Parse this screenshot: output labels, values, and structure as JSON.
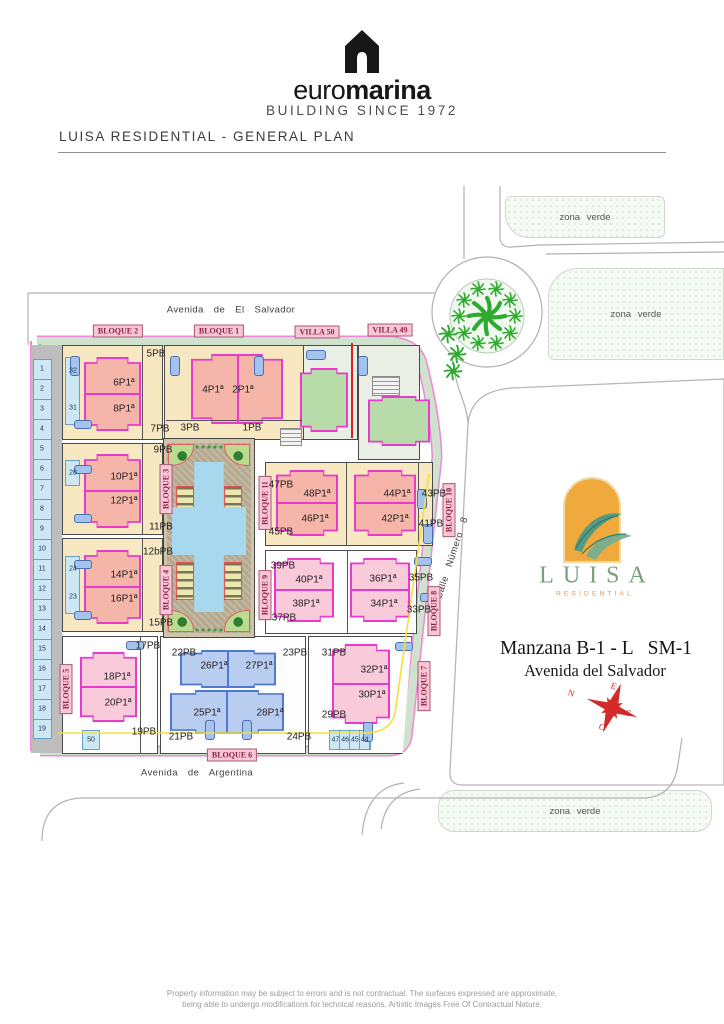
{
  "header": {
    "brand_euro": "euro",
    "brand_marina": "marina",
    "brand_tagline": "BUILDING SINCE 1972",
    "title": "LUISA RESIDENTIAL - GENERAL PLAN"
  },
  "map": {
    "streets": [
      {
        "t": "Avenida  de   El  Salvador",
        "x": 231,
        "y": 310
      },
      {
        "t": "Avenida  de  Argentina",
        "x": 197,
        "y": 773
      },
      {
        "t": "Calle  Número  8",
        "x": 452,
        "y": 558,
        "rot": -72
      }
    ],
    "badges": [
      {
        "t": "BLOQUE 2",
        "x": 118,
        "y": 331
      },
      {
        "t": "BLOQUE 1",
        "x": 219,
        "y": 331
      },
      {
        "t": "VILLA 50",
        "x": 317,
        "y": 332
      },
      {
        "t": "VILLA 49",
        "x": 390,
        "y": 330
      },
      {
        "t": "BLOQUE 6",
        "x": 232,
        "y": 755
      },
      {
        "t": "BLOQUE 5",
        "x": 66,
        "y": 689,
        "k": "v",
        "rot": 180
      },
      {
        "t": "BLOQUE 3",
        "x": 166,
        "y": 489,
        "k": "v",
        "rot": 180
      },
      {
        "t": "BLOQUE 4",
        "x": 166,
        "y": 590,
        "k": "v",
        "rot": 180
      },
      {
        "t": "BLOQUE 11",
        "x": 265,
        "y": 503,
        "k": "v",
        "rot": 180
      },
      {
        "t": "BLOQUE 9",
        "x": 265,
        "y": 595,
        "k": "v",
        "rot": 180
      },
      {
        "t": "BLOQUE 10",
        "x": 449,
        "y": 510,
        "k": "v",
        "rot": 180
      },
      {
        "t": "BLOQUE 8",
        "x": 434,
        "y": 611,
        "k": "v",
        "rot": 180
      },
      {
        "t": "BLOQUE 7",
        "x": 424,
        "y": 686,
        "k": "v",
        "rot": 180
      }
    ],
    "unit_labels": [
      {
        "t": "6P1ª",
        "x": 124,
        "y": 383,
        "k": "u"
      },
      {
        "t": "8P1ª",
        "x": 124,
        "y": 409,
        "k": "u"
      },
      {
        "t": "4P1ª",
        "x": 213,
        "y": 390,
        "k": "u"
      },
      {
        "t": "2P1ª",
        "x": 243,
        "y": 390,
        "k": "u"
      },
      {
        "t": "10P1ª",
        "x": 124,
        "y": 477,
        "k": "u"
      },
      {
        "t": "12P1ª",
        "x": 124,
        "y": 501,
        "k": "u"
      },
      {
        "t": "14P1ª",
        "x": 124,
        "y": 575,
        "k": "u"
      },
      {
        "t": "16P1ª",
        "x": 124,
        "y": 599,
        "k": "u"
      },
      {
        "t": "48P1ª",
        "x": 317,
        "y": 494,
        "k": "u"
      },
      {
        "t": "46P1ª",
        "x": 315,
        "y": 519,
        "k": "u"
      },
      {
        "t": "44P1ª",
        "x": 397,
        "y": 494,
        "k": "u"
      },
      {
        "t": "42P1ª",
        "x": 395,
        "y": 519,
        "k": "u"
      },
      {
        "t": "40P1ª",
        "x": 309,
        "y": 580,
        "k": "u"
      },
      {
        "t": "38P1ª",
        "x": 306,
        "y": 604,
        "k": "u"
      },
      {
        "t": "36P1ª",
        "x": 383,
        "y": 579,
        "k": "u"
      },
      {
        "t": "34P1ª",
        "x": 384,
        "y": 604,
        "k": "u"
      },
      {
        "t": "18P1ª",
        "x": 117,
        "y": 677,
        "k": "u"
      },
      {
        "t": "20P1ª",
        "x": 118,
        "y": 703,
        "k": "u"
      },
      {
        "t": "26P1ª",
        "x": 214,
        "y": 666,
        "k": "u"
      },
      {
        "t": "27P1ª",
        "x": 259,
        "y": 666,
        "k": "u"
      },
      {
        "t": "25P1ª",
        "x": 207,
        "y": 713,
        "k": "u"
      },
      {
        "t": "28P1ª",
        "x": 270,
        "y": 713,
        "k": "u"
      },
      {
        "t": "32P1ª",
        "x": 374,
        "y": 670,
        "k": "u"
      },
      {
        "t": "30P1ª",
        "x": 372,
        "y": 695,
        "k": "u"
      },
      {
        "t": "5PB",
        "x": 156,
        "y": 354,
        "k": "pb"
      },
      {
        "t": "7PB",
        "x": 160,
        "y": 429,
        "k": "pb"
      },
      {
        "t": "9PB",
        "x": 163,
        "y": 450,
        "k": "pb"
      },
      {
        "t": "11PB",
        "x": 161,
        "y": 527,
        "k": "pb"
      },
      {
        "t": "12bPB",
        "x": 158,
        "y": 552,
        "k": "pb"
      },
      {
        "t": "15PB",
        "x": 161,
        "y": 623,
        "k": "pb"
      },
      {
        "t": "3PB",
        "x": 190,
        "y": 428,
        "k": "pb"
      },
      {
        "t": "1PB",
        "x": 252,
        "y": 428,
        "k": "pb"
      },
      {
        "t": "47PB",
        "x": 281,
        "y": 485,
        "k": "pb"
      },
      {
        "t": "45PB",
        "x": 281,
        "y": 532,
        "k": "pb"
      },
      {
        "t": "43PB",
        "x": 434,
        "y": 494,
        "k": "pb"
      },
      {
        "t": "41PB",
        "x": 431,
        "y": 524,
        "k": "pb"
      },
      {
        "t": "39PB",
        "x": 283,
        "y": 566,
        "k": "pb"
      },
      {
        "t": "37PB",
        "x": 284,
        "y": 618,
        "k": "pb"
      },
      {
        "t": "35PB",
        "x": 421,
        "y": 578,
        "k": "pb"
      },
      {
        "t": "33PB",
        "x": 419,
        "y": 610,
        "k": "pb"
      },
      {
        "t": "17PB",
        "x": 148,
        "y": 646,
        "k": "pb"
      },
      {
        "t": "19PB",
        "x": 144,
        "y": 732,
        "k": "pb"
      },
      {
        "t": "22PB",
        "x": 184,
        "y": 653,
        "k": "pb"
      },
      {
        "t": "23PB",
        "x": 295,
        "y": 653,
        "k": "pb"
      },
      {
        "t": "21PB",
        "x": 181,
        "y": 737,
        "k": "pb"
      },
      {
        "t": "24PB",
        "x": 299,
        "y": 737,
        "k": "pb"
      },
      {
        "t": "31PB",
        "x": 334,
        "y": 653,
        "k": "pb"
      },
      {
        "t": "29PB",
        "x": 334,
        "y": 715,
        "k": "pb"
      }
    ],
    "parking_left": [
      {
        "t": "1",
        "x": 42,
        "y": 369
      },
      {
        "t": "2",
        "x": 42,
        "y": 389
      },
      {
        "t": "3",
        "x": 42,
        "y": 409
      },
      {
        "t": "4",
        "x": 42,
        "y": 429
      },
      {
        "t": "5",
        "x": 42,
        "y": 449
      },
      {
        "t": "6",
        "x": 42,
        "y": 469
      },
      {
        "t": "7",
        "x": 42,
        "y": 489
      },
      {
        "t": "8",
        "x": 42,
        "y": 509
      },
      {
        "t": "9",
        "x": 42,
        "y": 529
      },
      {
        "t": "10",
        "x": 42,
        "y": 549
      },
      {
        "t": "11",
        "x": 42,
        "y": 569
      },
      {
        "t": "12",
        "x": 42,
        "y": 589
      },
      {
        "t": "13",
        "x": 42,
        "y": 609
      },
      {
        "t": "14",
        "x": 42,
        "y": 629
      },
      {
        "t": "15",
        "x": 42,
        "y": 649
      },
      {
        "t": "16",
        "x": 42,
        "y": 669
      },
      {
        "t": "17",
        "x": 42,
        "y": 689
      },
      {
        "t": "18",
        "x": 42,
        "y": 709
      },
      {
        "t": "19",
        "x": 42,
        "y": 729
      }
    ],
    "parking_other": [
      {
        "t": "32",
        "x": 73,
        "y": 371
      },
      {
        "t": "31",
        "x": 73,
        "y": 408
      },
      {
        "t": "28",
        "x": 73,
        "y": 473
      },
      {
        "t": "24",
        "x": 73,
        "y": 569
      },
      {
        "t": "23",
        "x": 73,
        "y": 597
      },
      {
        "t": "50",
        "x": 91,
        "y": 740
      },
      {
        "t": "47 46 45 44",
        "x": 350,
        "y": 740
      }
    ],
    "zones": [
      {
        "label": "zona verde",
        "x": 505,
        "y": 196,
        "w": 160,
        "h": 42,
        "r": "6px 6px 6px 24px"
      },
      {
        "label": "zona verde",
        "x": 548,
        "y": 268,
        "w": 176,
        "h": 92,
        "r": "30px 0 0 6px"
      },
      {
        "label": "zona verde",
        "x": 438,
        "y": 790,
        "w": 274,
        "h": 42,
        "r": "16px"
      }
    ],
    "cars": [
      {
        "x": 70,
        "y": 356,
        "w": 10,
        "h": 20
      },
      {
        "x": 170,
        "y": 356,
        "w": 10,
        "h": 20
      },
      {
        "x": 254,
        "y": 356,
        "w": 10,
        "h": 20
      },
      {
        "x": 306,
        "y": 350,
        "w": 20,
        "h": 10
      },
      {
        "x": 358,
        "y": 356,
        "w": 10,
        "h": 20
      },
      {
        "x": 74,
        "y": 420,
        "w": 18,
        "h": 9
      },
      {
        "x": 74,
        "y": 465,
        "w": 18,
        "h": 9
      },
      {
        "x": 74,
        "y": 514,
        "w": 18,
        "h": 9
      },
      {
        "x": 74,
        "y": 560,
        "w": 18,
        "h": 9
      },
      {
        "x": 74,
        "y": 611,
        "w": 18,
        "h": 9
      },
      {
        "x": 126,
        "y": 641,
        "w": 18,
        "h": 9
      },
      {
        "x": 395,
        "y": 642,
        "w": 18,
        "h": 9
      },
      {
        "x": 417,
        "y": 489,
        "w": 10,
        "h": 20
      },
      {
        "x": 423,
        "y": 524,
        "w": 10,
        "h": 20
      },
      {
        "x": 414,
        "y": 557,
        "w": 18,
        "h": 9
      },
      {
        "x": 420,
        "y": 593,
        "w": 18,
        "h": 9
      },
      {
        "x": 205,
        "y": 720,
        "w": 10,
        "h": 20
      },
      {
        "x": 242,
        "y": 720,
        "w": 10,
        "h": 20
      },
      {
        "x": 363,
        "y": 722,
        "w": 10,
        "h": 20
      }
    ]
  },
  "side_panel": {
    "logo_name": "LUISA",
    "logo_sub": "RESIDENTIAL",
    "line1": "Manzana B-1 - L   SM-1",
    "line2": "Avenida del Salvador",
    "compass": {
      "n": "N",
      "e": "E",
      "s": "S",
      "o": "O"
    }
  },
  "footer": {
    "line1": "Property information may be subject to errors and is not contractual. The surfaces expressed are approximate,",
    "line2": "being able to undergo modifications for technical reasons. Artistic Images Free Of Contractual Nature."
  },
  "colors": {
    "building_outline": "#e83acc",
    "building_salmon": "#f5b5a9",
    "building_pink": "#f9cada",
    "building_blue": "#b9cdf0",
    "villa_green": "#b7dcaa",
    "plot_tan": "#f8e8c1",
    "sidewalk_band": "#cfe2cd",
    "pool_blue": "#a7d8ee",
    "badge_pink": "#f9c6d8",
    "badge_text": "#8c2342",
    "compass_red": "#d42a2a",
    "logo_orange": "#f0a93c",
    "logo_green": "#7ba07f",
    "utility_yellow": "#f2e13c",
    "boundary_red": "#e02020"
  }
}
